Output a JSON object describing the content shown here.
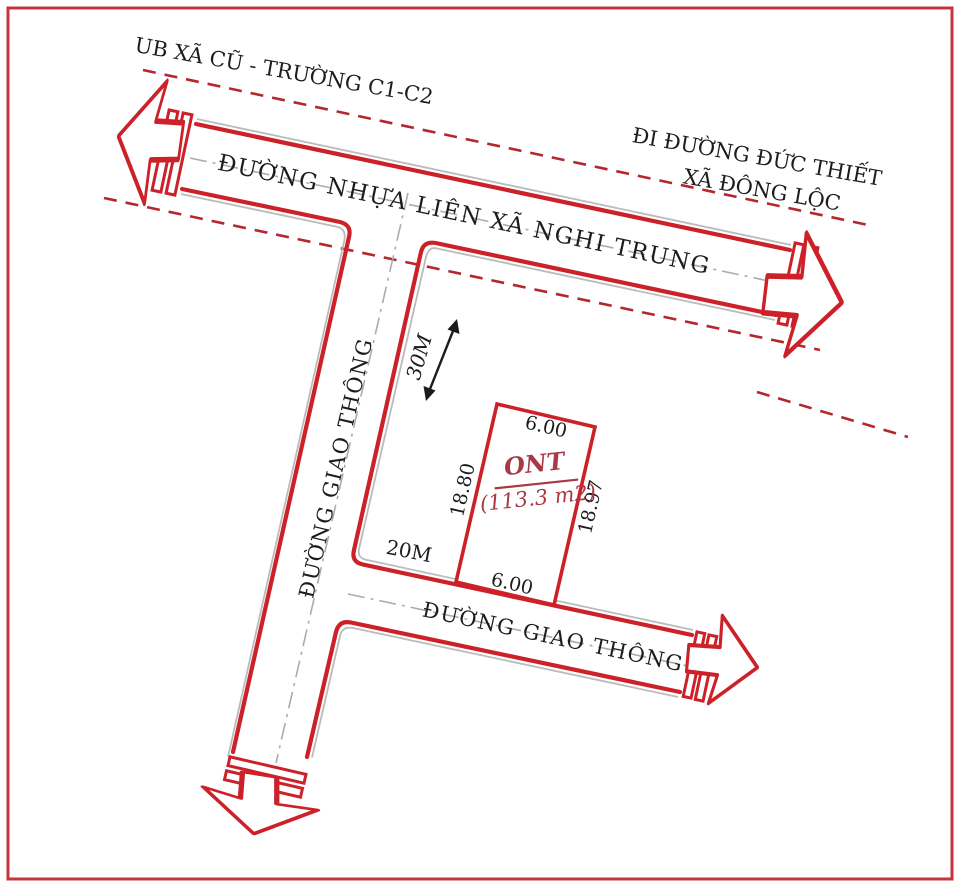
{
  "diagram": {
    "landmark_top_left": "UB XÃ CŨ - TRƯỜNG C1-C2",
    "direction_note": {
      "line1": "ĐI ĐƯỜNG ĐỨC THIẾT",
      "line2": "XÃ ĐÔNG LỘC"
    },
    "roads": {
      "main_road_name": "ĐƯỜNG NHỰA LIÊN XÃ NGHI TRUNG",
      "vertical_road_name": "ĐƯỜNG GIAO THÔNG",
      "bottom_road_name": "ĐƯỜNG GIAO THÔNG"
    },
    "distances": {
      "to_main_road": "30M",
      "to_junction": "20M"
    },
    "plot": {
      "land_type": "ONT",
      "area": "(113.3 m2)",
      "edge_top": "6.00",
      "edge_left": "18.80",
      "edge_right": "18.97",
      "edge_bottom": "6.00"
    }
  },
  "colors": {
    "road_red": "#cc2128",
    "dashed_red": "#b5272e",
    "plot_label_red": "#a83a45",
    "gray_line": "#bbbbbb",
    "centerline_gray": "#a9adad",
    "text_black": "#1c1c1c",
    "frame_red": "#c4343b",
    "background": "#ffffff"
  }
}
